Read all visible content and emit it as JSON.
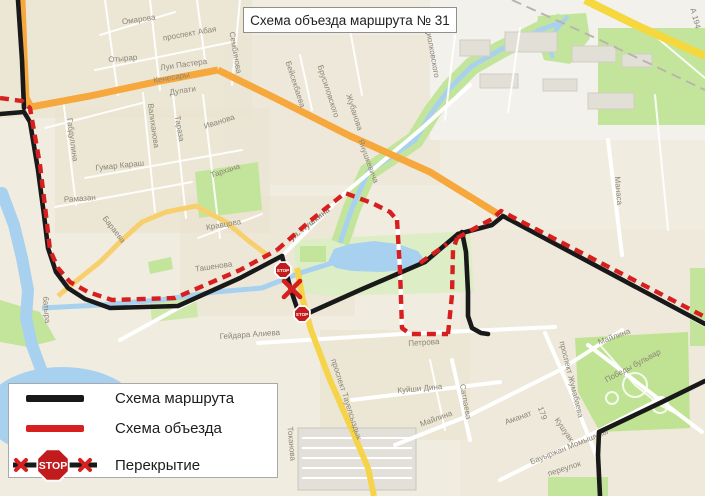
{
  "title": "Схема объезда маршрута № 31",
  "legend": {
    "route_label": "Схема маршрута",
    "detour_label": "Схема объезда",
    "closure_label": "Перекрытие",
    "stop_text": "STOP",
    "route_color": "#191919",
    "detour_color": "#d71f1f"
  },
  "map": {
    "stop_text": "STOP",
    "street_labels": [
      {
        "t": "Омарова",
        "x": 139,
        "y": 22,
        "r": -8
      },
      {
        "t": "проспект Абая",
        "x": 190,
        "y": 36,
        "r": -10
      },
      {
        "t": "Отырар",
        "x": 123,
        "y": 61,
        "r": -5
      },
      {
        "t": "Луи Пастера",
        "x": 184,
        "y": 67,
        "r": -8
      },
      {
        "t": "Кенесары",
        "x": 172,
        "y": 80,
        "r": -10,
        "c": "#7c6a3f"
      },
      {
        "t": "Дулати",
        "x": 183,
        "y": 93,
        "r": -8
      },
      {
        "t": "Сембинова",
        "x": 233,
        "y": 53,
        "r": 80
      },
      {
        "t": "Циолковского",
        "x": 430,
        "y": 53,
        "r": 80
      },
      {
        "t": "А 194",
        "x": 693,
        "y": 19,
        "r": 75,
        "c": "#7c6a3f"
      },
      {
        "t": "Габдуллина",
        "x": 70,
        "y": 140,
        "r": 82
      },
      {
        "t": "Валиханова",
        "x": 151,
        "y": 126,
        "r": 82
      },
      {
        "t": "Тараза",
        "x": 177,
        "y": 129,
        "r": 80
      },
      {
        "t": "Иванова",
        "x": 220,
        "y": 124,
        "r": -18
      },
      {
        "t": "Гумар Караш",
        "x": 120,
        "y": 168,
        "r": -6
      },
      {
        "t": "Тархана",
        "x": 226,
        "y": 173,
        "r": -18
      },
      {
        "t": "Рамазан",
        "x": 80,
        "y": 201,
        "r": -4
      },
      {
        "t": "Бараева",
        "x": 112,
        "y": 231,
        "r": 52
      },
      {
        "t": "батыра",
        "x": 44,
        "y": 310,
        "r": 85
      },
      {
        "t": "Бейсекбаева",
        "x": 293,
        "y": 85,
        "r": 72
      },
      {
        "t": "Брусиловского",
        "x": 326,
        "y": 92,
        "r": 72
      },
      {
        "t": "Жубанова",
        "x": 352,
        "y": 113,
        "r": 72
      },
      {
        "t": "Янушкевича",
        "x": 366,
        "y": 162,
        "r": 70
      },
      {
        "t": "Манаса",
        "x": 616,
        "y": 191,
        "r": 85
      },
      {
        "t": "ул. Пушкина",
        "x": 311,
        "y": 226,
        "r": -38,
        "c": "#5f5b50",
        "s": 9,
        "b": 1
      },
      {
        "t": "Кравцова",
        "x": 224,
        "y": 227,
        "r": -10
      },
      {
        "t": "Ташенова",
        "x": 214,
        "y": 269,
        "r": -8
      },
      {
        "t": "Гейдара Алиева",
        "x": 250,
        "y": 337,
        "r": -4
      },
      {
        "t": "Петрова",
        "x": 424,
        "y": 345,
        "r": -4
      },
      {
        "t": "Куйши Дина",
        "x": 420,
        "y": 391,
        "r": -5
      },
      {
        "t": "Майлина",
        "x": 437,
        "y": 421,
        "r": -20
      },
      {
        "t": "Майлина",
        "x": 615,
        "y": 339,
        "r": -20
      },
      {
        "t": "Победы бульвар",
        "x": 634,
        "y": 368,
        "r": -28
      },
      {
        "t": "проспект Жумабаева",
        "x": 569,
        "y": 380,
        "r": 76
      },
      {
        "t": "Сатпаева",
        "x": 463,
        "y": 402,
        "r": 80
      },
      {
        "t": "проспект Тауелсыздык",
        "x": 344,
        "y": 400,
        "r": 72
      },
      {
        "t": "Токанова",
        "x": 289,
        "y": 444,
        "r": 85
      },
      {
        "t": "Аманат",
        "x": 519,
        "y": 420,
        "r": -20
      },
      {
        "t": "179",
        "x": 540,
        "y": 414,
        "r": 70
      },
      {
        "t": "Кушуак",
        "x": 562,
        "y": 431,
        "r": 55
      },
      {
        "t": "Бауыржан Момышулы",
        "x": 570,
        "y": 449,
        "r": -22
      },
      {
        "t": "переулок",
        "x": 565,
        "y": 471,
        "r": -18
      }
    ],
    "routes": {
      "black": [
        "18,0 22,60 24,108",
        "0,114 24,112 30,122 38,170 44,215 48,248 56,272 68,288 85,299 110,308 178,306 240,278 282,256",
        "282,256 290,287 297,308 302,316",
        "302,316 360,290 425,262 458,234",
        "458,234 492,225 503,216",
        "503,216 705,324",
        "462,232 466,252 468,292 468,316 472,328 481,333 488,334",
        "705,381 660,403 599,432 598,455 600,496"
      ],
      "red": [
        "0,98 22,101 30,108 40,165 46,215 50,250 58,268 70,282 88,292 112,300 175,298 240,270 277,250",
        "277,250 310,221 345,193 372,203 390,212 397,220",
        "397,220 400,270 402,328 410,334 448,334",
        "448,334 452,295 453,250 457,238",
        "420,263 447,244",
        "457,238 492,219 501,211 705,317"
      ]
    },
    "stops": [
      {
        "x": 283,
        "y": 270
      },
      {
        "x": 302,
        "y": 314
      }
    ],
    "closure": {
      "x": 292,
      "y": 289
    }
  }
}
